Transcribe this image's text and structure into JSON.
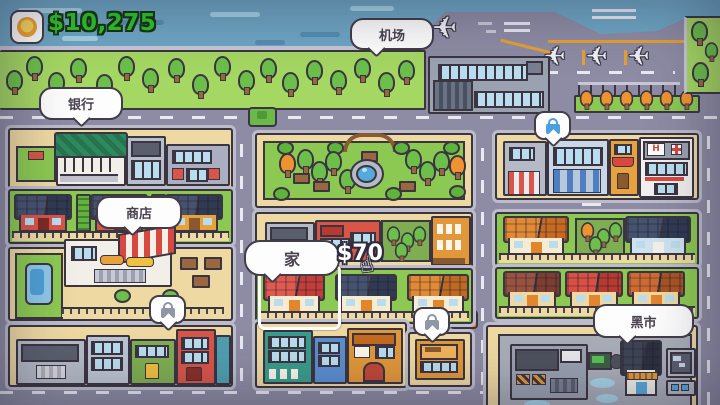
{
  "hud": {
    "money": "$10,275"
  },
  "bubbles": {
    "airport": "机场",
    "bank": "银行",
    "shop": "商店",
    "home": "家",
    "black_market": "黑市"
  },
  "home_offer": {
    "price": "$70"
  },
  "misc": {
    "hospital_sign": "H"
  },
  "locks": [
    {
      "location": "commercial-district-top-right",
      "color": "#4aa0dc"
    },
    {
      "location": "red-building-bottom-left",
      "color": "#8f96a6"
    },
    {
      "location": "orange-building-bottom-middle",
      "color": "#8f96a6"
    }
  ],
  "airport": {
    "parked_planes": 3,
    "taxiing_planes": 1
  },
  "vehicles": {
    "green_car": "#6db84a",
    "orange_car": "#e0883a"
  },
  "palette": {
    "water": "#6ea6c5",
    "road": "#8d8ca4",
    "block_tan": "#eed9a2",
    "park_grass": "#a5d763",
    "lawn_green": "#8cc952",
    "outline": "#3b3542",
    "money_green": "#2fc42f",
    "bubble_bg": "#fdfdfd",
    "bubble_text": "#4a4350"
  }
}
